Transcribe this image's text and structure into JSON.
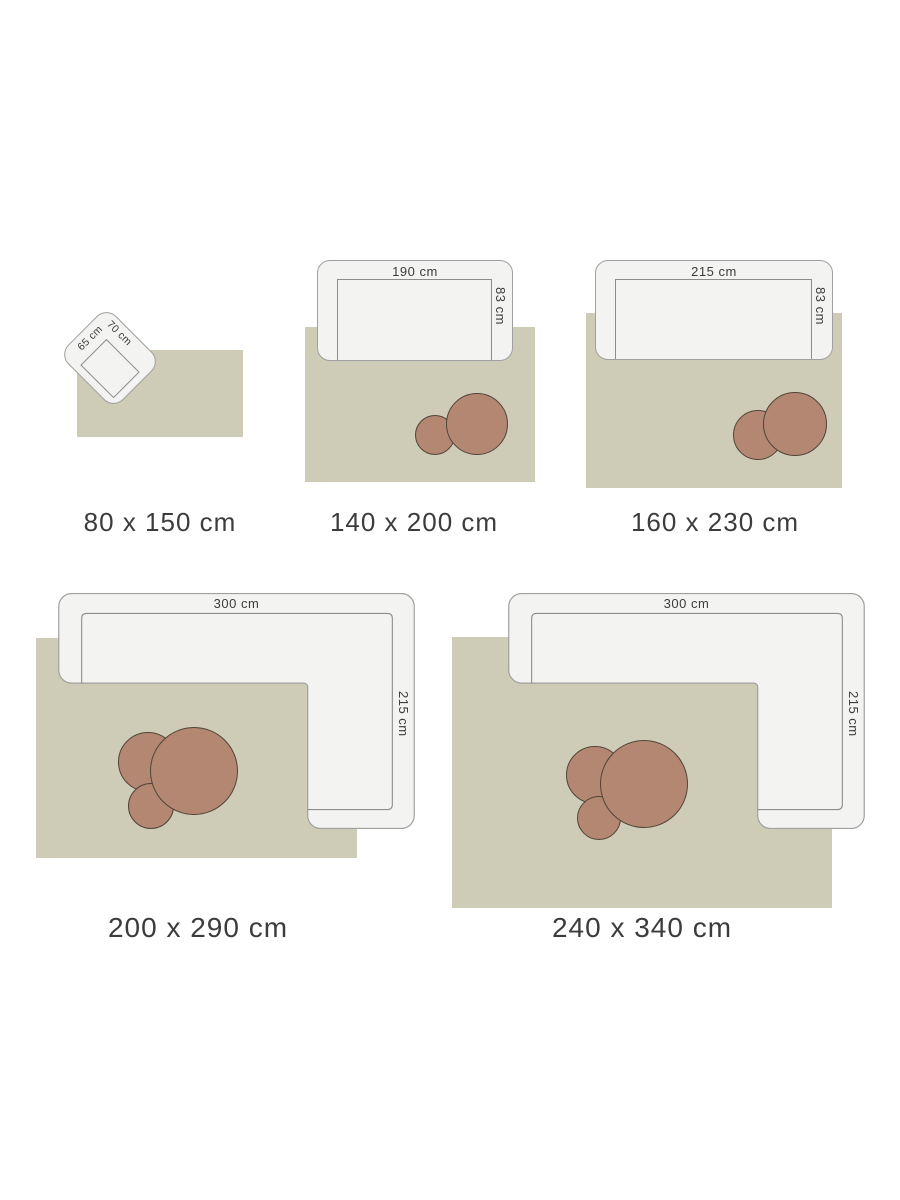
{
  "figures": [
    {
      "id": "80x150",
      "caption": "80 x 150 cm",
      "furniture": "armchair",
      "labels": {
        "width": "65 cm",
        "depth": "70 cm"
      }
    },
    {
      "id": "140x200",
      "caption": "140 x 200 cm",
      "furniture": "sofa",
      "labels": {
        "width": "190 cm",
        "depth": "83 cm"
      }
    },
    {
      "id": "160x230",
      "caption": "160 x 230 cm",
      "furniture": "sofa",
      "labels": {
        "width": "215 cm",
        "depth": "83 cm"
      }
    },
    {
      "id": "200x290",
      "caption": "200 x 290 cm",
      "furniture": "corner-sofa",
      "labels": {
        "width": "300 cm",
        "depth": "215 cm"
      }
    },
    {
      "id": "240x340",
      "caption": "240 x 340 cm",
      "furniture": "corner-sofa",
      "labels": {
        "width": "300 cm",
        "depth": "215 cm"
      }
    }
  ],
  "colors": {
    "rug": "#cecbb6",
    "pouf": "#b48773",
    "pouf_border": "#514437",
    "sofa_fill": "#f3f3f1",
    "sofa_border": "#a0a0a0",
    "seat_line": "#8c8c8c",
    "text": "#3c3c3c",
    "background": "#ffffff"
  }
}
